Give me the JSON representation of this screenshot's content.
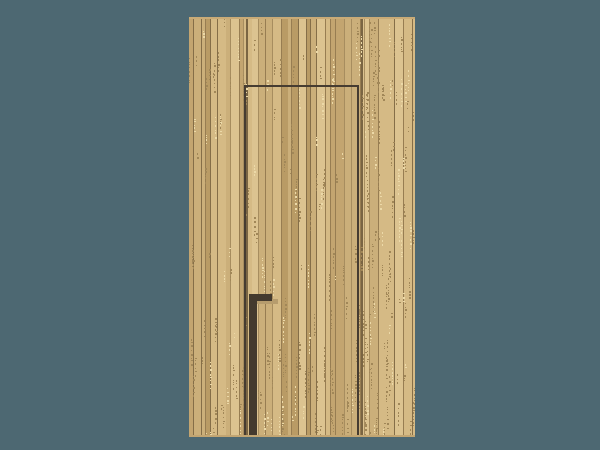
{
  "scene": {
    "description": "Pixel-art wooden plank wall with an inset door outline and a dark L-shaped door handle on a slate-blue background",
    "background_color": "#4d6872",
    "wall": {
      "x": 189,
      "y": 17,
      "width": 226,
      "height": 420,
      "base_color": "#d9bd8a"
    },
    "door": {
      "frame_color": "#463c31",
      "x": 244,
      "y": 85,
      "width": 115,
      "height": 350,
      "line_thickness": 2
    },
    "handle": {
      "color": "#443a2e",
      "bar": {
        "x": 250,
        "y": 294,
        "width": 22,
        "height": 7
      },
      "shaft": {
        "x": 249,
        "y": 294,
        "width": 8,
        "height": 141
      },
      "smudge": {
        "x": 253,
        "y": 299,
        "width": 25,
        "height": 5,
        "color": "#b69c6d"
      }
    },
    "texture": {
      "seed": 9,
      "stripe_colors": [
        "#dcc390",
        "#d5ba85",
        "#cbaf7a",
        "#c3a570",
        "#b99b65"
      ],
      "stripe_weights": [
        0.34,
        0.26,
        0.2,
        0.12,
        0.08
      ],
      "separator_colors": [
        "#a78d5f",
        "#977d52",
        "#856e48"
      ],
      "noise_dark": "#a18758",
      "noise_light": "#ecd9a8",
      "seam_color": "#7a6543",
      "seams_x": [
        57,
        172
      ],
      "top_edge_color": "#c9ab77",
      "bottom_edge_color": "#c2a572"
    }
  }
}
